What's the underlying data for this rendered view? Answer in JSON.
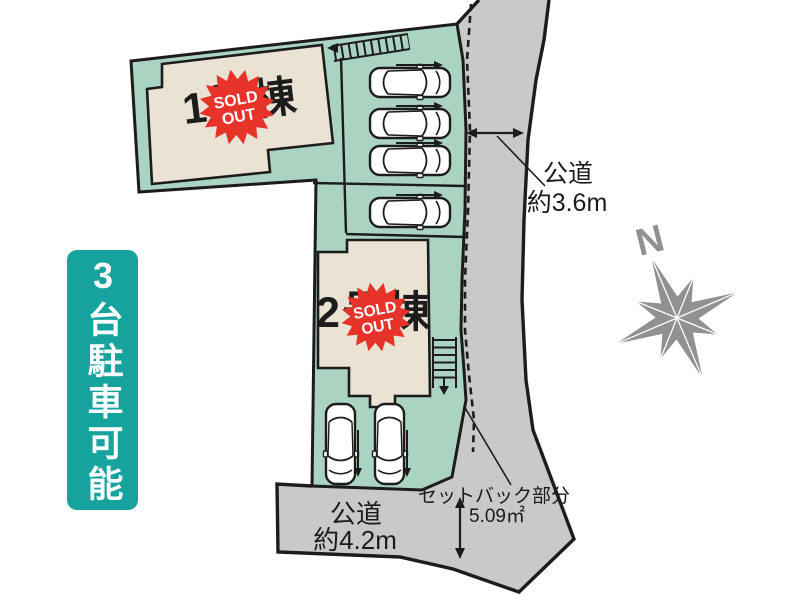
{
  "banner": {
    "text": "3台駐車可能"
  },
  "buildings": [
    {
      "label": "1号棟"
    },
    {
      "label": "2号棟"
    }
  ],
  "badge": {
    "line1": "SOLD",
    "line2": "OUT"
  },
  "roads": {
    "right": {
      "name": "公道",
      "width": "約3.6m"
    },
    "bottom": {
      "name": "公道",
      "width": "約4.2m"
    }
  },
  "setback": {
    "label": "セットバック部分",
    "area": "5.09㎡"
  },
  "compass": {
    "label": "N"
  },
  "colors": {
    "land": "#abd3c2",
    "road": "#c9c9c9",
    "building": "#eae3d3",
    "badge": "#e8332b",
    "banner": "#16a29d",
    "line": "#1c1c1c",
    "compass": "#8f9193",
    "car": "#ffffff"
  }
}
